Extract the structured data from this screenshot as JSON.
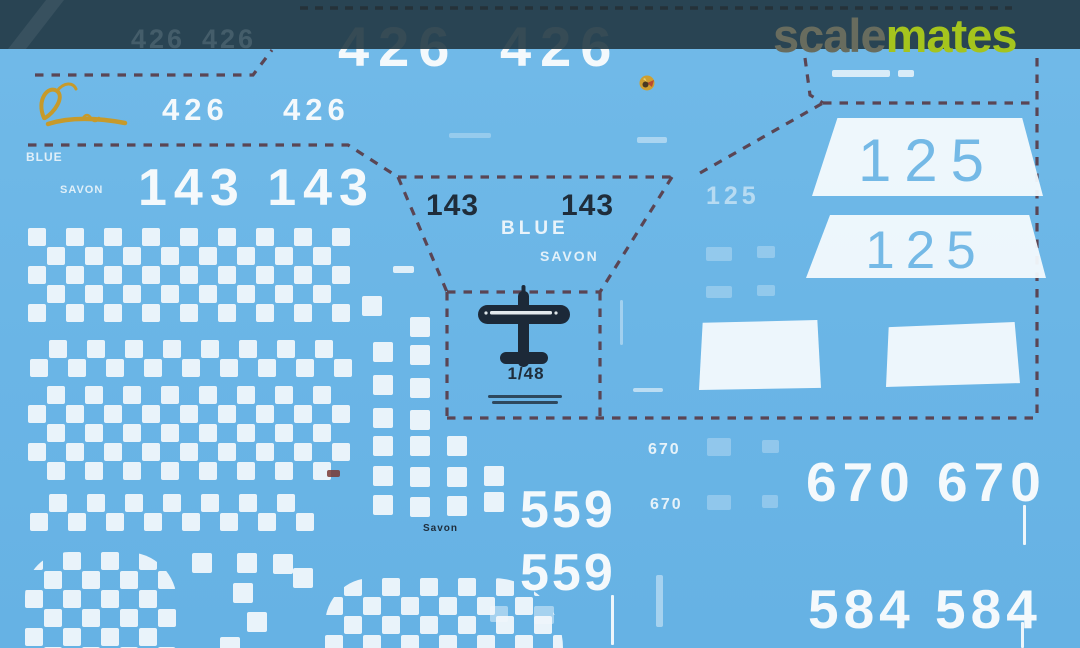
{
  "watermark": {
    "scale": "scale",
    "mates": "mates"
  },
  "sheet": {
    "colors": {
      "sheet_blue": "#6ab5e6",
      "header_overlay": "#21373f",
      "decal_white": "#f4f9fc",
      "navy_ink": "#1f2d3b",
      "dash_red": "#583640",
      "logo_gold": "#c79a2a",
      "watermark_gray": "#686c5e",
      "watermark_lime": "#a5c41d"
    },
    "texts": {
      "top_426_left": "426",
      "top_426_right": "426",
      "ghost_426_a": "426",
      "ghost_426_b": "426",
      "small_426_left": "426",
      "small_426_right": "426",
      "big_143_pair": "143 143",
      "black_143_left": "143",
      "black_143_right": "143",
      "blue_small": "BLUE",
      "savon_small": "SAVON",
      "blue_center": "BLUE",
      "savon_center": "SAVON",
      "savon_dark": "Savon",
      "num_125_top": "125",
      "num_125_bottom": "125",
      "num_125_faint": "125",
      "small_670_a": "670",
      "small_670_b": "670",
      "big_670_pair": "670 670",
      "big_584_pair": "584 584",
      "num_559_a": "559",
      "num_559_b": "559",
      "scale_label": "1/48"
    },
    "checker_cell": 19,
    "checker_bands": [
      {
        "x": 28,
        "y": 228,
        "cols": 17,
        "rows": 5,
        "parity": 0
      },
      {
        "x": 30,
        "y": 340,
        "cols": 17,
        "rows": 2,
        "parity": 1
      },
      {
        "x": 28,
        "y": 386,
        "cols": 17,
        "rows": 5,
        "parity": 1
      },
      {
        "x": 30,
        "y": 494,
        "cols": 15,
        "rows": 2,
        "parity": 1
      }
    ],
    "checker_blobs": [
      {
        "x": 25,
        "y": 552,
        "w": 152,
        "h": 96,
        "parity": 0,
        "radius": "44px 50px 4px 0"
      },
      {
        "x": 325,
        "y": 578,
        "w": 238,
        "h": 70,
        "parity": 1,
        "radius": "60px 90px 0 0"
      }
    ],
    "loose_squares": [
      [
        410,
        317
      ],
      [
        373,
        342
      ],
      [
        410,
        345
      ],
      [
        373,
        375
      ],
      [
        410,
        378
      ],
      [
        373,
        408
      ],
      [
        410,
        410
      ],
      [
        373,
        436
      ],
      [
        410,
        436
      ],
      [
        447,
        436
      ],
      [
        373,
        466
      ],
      [
        410,
        467
      ],
      [
        447,
        467
      ],
      [
        484,
        466
      ],
      [
        373,
        495
      ],
      [
        410,
        497
      ],
      [
        447,
        496
      ],
      [
        484,
        492
      ],
      [
        362,
        296
      ],
      [
        192,
        553
      ],
      [
        237,
        553
      ],
      [
        273,
        554
      ],
      [
        293,
        568
      ],
      [
        233,
        583
      ],
      [
        247,
        612
      ],
      [
        220,
        637
      ]
    ],
    "faint_squares": [
      [
        707,
        438,
        24,
        18
      ],
      [
        762,
        440,
        17,
        13
      ],
      [
        707,
        495,
        24,
        15
      ],
      [
        762,
        495,
        16,
        13
      ],
      [
        706,
        247,
        26,
        14
      ],
      [
        757,
        246,
        18,
        12
      ],
      [
        706,
        286,
        26,
        12
      ],
      [
        757,
        285,
        18,
        11
      ]
    ],
    "text_bars": [
      [
        832,
        70,
        58,
        7,
        0.8,
        "w"
      ],
      [
        898,
        70,
        16,
        7,
        0.8,
        "w"
      ],
      [
        637,
        137,
        30,
        6,
        0.45,
        "w"
      ],
      [
        449,
        133,
        42,
        5,
        0.3,
        "w"
      ],
      [
        393,
        266,
        21,
        7,
        0.85,
        "w"
      ],
      [
        633,
        388,
        30,
        4,
        0.6,
        "w"
      ],
      [
        656,
        575,
        7,
        52,
        0.45,
        "w"
      ],
      [
        620,
        300,
        3,
        45,
        0.4,
        "w"
      ],
      [
        490,
        606,
        18,
        16,
        0.45,
        "w"
      ],
      [
        534,
        606,
        20,
        18,
        0.45,
        "w"
      ],
      [
        488,
        395,
        74,
        3,
        0.8,
        "d"
      ],
      [
        492,
        401,
        66,
        3,
        0.8,
        "d"
      ],
      [
        327,
        470,
        13,
        7,
        0.85,
        "r"
      ]
    ],
    "white_lines": [
      [
        1023,
        505,
        40
      ],
      [
        1021,
        622,
        26
      ],
      [
        611,
        595,
        50
      ]
    ]
  }
}
